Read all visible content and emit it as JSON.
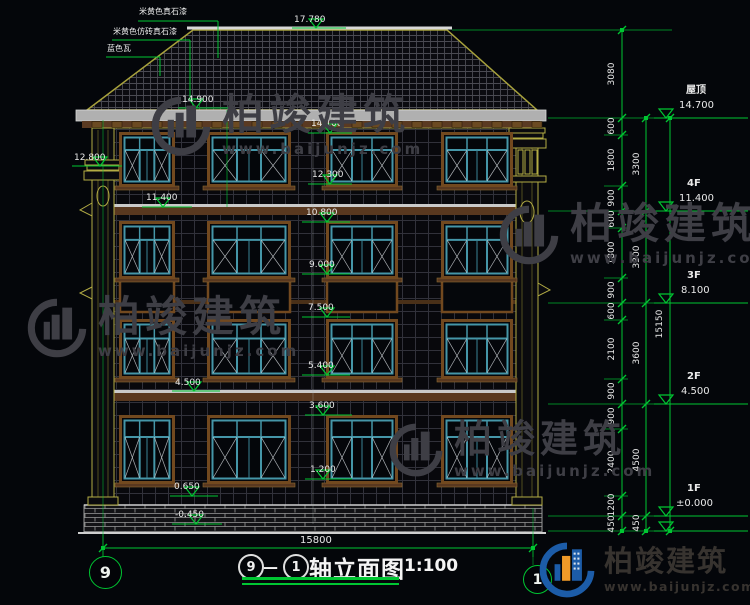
{
  "drawing": {
    "title_axis_start": "9",
    "title_dash": "—",
    "title_axis_end": "1",
    "title_text": "轴立面图",
    "title_scale": "1:100",
    "axis_bubble_left": "9",
    "axis_bubble_right": "1"
  },
  "material_notes": [
    "米黄色真石漆",
    "米黄色仿砖真石漆",
    "蓝色瓦"
  ],
  "elevation_markers": [
    "17.780",
    "14.900",
    "14.100",
    "12.800",
    "12.300",
    "11.400",
    "10.800",
    "9.000",
    "7.500",
    "5.400",
    "4.500",
    "3.600",
    "1.200",
    "0.650",
    "-0.450"
  ],
  "floor_markers": [
    {
      "label": "屋顶",
      "value": "14.700"
    },
    {
      "label": "4F",
      "value": "11.400"
    },
    {
      "label": "3F",
      "value": "8.100"
    },
    {
      "label": "2F",
      "value": "4.500"
    },
    {
      "label": "1F",
      "value": "±0.000"
    }
  ],
  "dimensions": {
    "inner_chain": [
      "3080",
      "600",
      "1800",
      "900",
      "600",
      "1800",
      "900",
      "600",
      "2100",
      "900",
      "900",
      "2400",
      "1200",
      "450"
    ],
    "floor_chain": [
      "3300",
      "3300",
      "3600",
      "4500",
      "450"
    ],
    "overall_height": "15150",
    "overall_width": "15800"
  },
  "watermark": {
    "name": "柏竣建筑",
    "url": "www.baijunjz.com"
  },
  "brand_logo": {
    "name": "柏竣建筑",
    "url": "www.baijunjz.com"
  },
  "colors": {
    "dim_green": "#00c632",
    "window_teal": "#4596a8",
    "trim_yellow": "#b3ac44",
    "surround_brown": "#72491f",
    "logo_blue": "#1c5ca8",
    "logo_orange": "#f09a28"
  }
}
